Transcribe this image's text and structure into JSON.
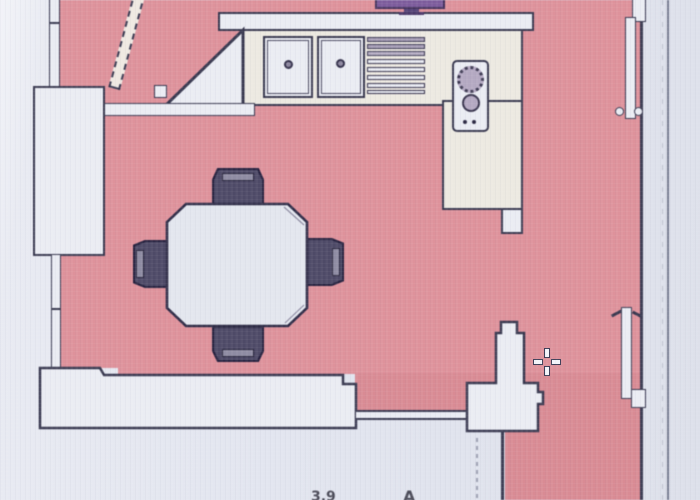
{
  "document": {
    "kind": "scanned architectural floor plan (photo of print)",
    "view": "top-down plan of a kitchen / dining room, partially cropped"
  },
  "cursor": {
    "type": "crosshair",
    "x": 547,
    "y": 362
  },
  "colors": {
    "floor": "#e0919b",
    "floor-deep": "#dc8a94",
    "paper": "#e2e5ef",
    "wall": "#eaecf3",
    "counter": "#ece9e1",
    "line": "#383850",
    "chair": "#4e4a68",
    "chair-slot": "#8f8ca4",
    "burner": "#b4a9c3",
    "tv": "#7e5c9e",
    "leaf": "#efe9e2",
    "sheet-line": "#5a5f78"
  },
  "inventory": {
    "entry_door": {
      "location": "top-left",
      "state": "open",
      "leaf_style": "dashed"
    },
    "kitchen_counter": {
      "shape": "L",
      "sink_basins": 2,
      "drainer_slats": 8,
      "hob_burners": 2,
      "hob_dots": 2
    },
    "dining_table": {
      "shape": "octagonal",
      "chairs": 4
    },
    "tv_unit": {
      "location": "top edge, cut off"
    },
    "right_wall_openings": [
      {
        "position": "top",
        "leaf": true,
        "knobs": 2
      },
      {
        "position": "bottom",
        "leaf": true,
        "knobs": 0
      }
    ],
    "bottom_wall": {
      "opening": "wide threshold with double track line"
    }
  },
  "artifacts": {
    "partial_dimension": "3.9",
    "partial_symbol": "A"
  }
}
